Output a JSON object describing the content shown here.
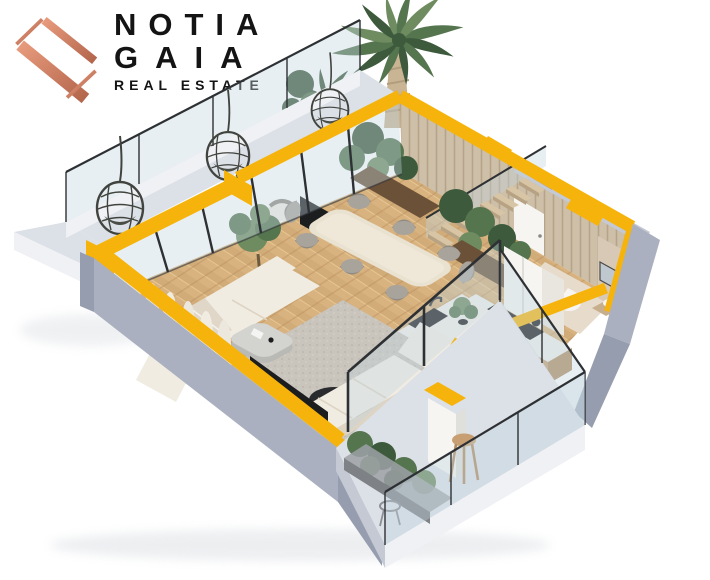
{
  "brand": {
    "line1": "NOTIA",
    "line2": "GAIA",
    "tagline": "REAL ESTATE",
    "mark": "ng-monogram"
  },
  "palette": {
    "yellow": "#F6B30B",
    "yellowDeep": "#DE9C00",
    "grayWall": "#AAB0BF",
    "grayWallLight": "#C4C9D4",
    "grayWallDark": "#969DAE",
    "slabTop": "#DCE0E7",
    "slabSide": "#F0F1F5",
    "glassTint": "rgba(195,212,224,0.38)",
    "frameDark": "#2E3134",
    "floorWood": "#D9B37F",
    "floorWoodDark": "#C2996A",
    "slatWood": "#CDBFA8",
    "slatLine": "#B5A489",
    "beigeWall": "#D8C9B6",
    "beigeLight": "#E7DCCB",
    "cream": "#F1ECE2",
    "creamShadow": "#DDD4C4",
    "rugGray": "#C9C4BC",
    "chairGray": "#A8A49C",
    "chairGrayDark": "#8F8B83",
    "tableCream": "#EAE2D1",
    "islandTop": "#F0EDE7",
    "islandSideA": "#C9C3B9",
    "islandSideB": "#BAB4A9",
    "counterWood": "#C5A476",
    "blackSoft": "#1C1D1F",
    "whiteSoft": "#F6F5F2",
    "green1": "#55754F",
    "green2": "#3D5A3C",
    "green3": "#6E8C60",
    "planterWood": "#6B5138",
    "trunkTan": "#C9B493",
    "logoCoral1": "#E89A7C",
    "logoCoral2": "#B3664C",
    "textDark": "#141414",
    "shadowTint": "#CBD0D7"
  },
  "scene": {
    "type": "isometric-apartment-cutaway-render",
    "elements": [
      "palm-tree",
      "balcony-hanging-chairs",
      "glass-railing",
      "living-sofas",
      "area-rug",
      "coffee-tables",
      "tv-screen",
      "dining-table-8-seats",
      "kitchen-island",
      "bar-stools",
      "kitchen-counter",
      "cooktop",
      "fridge",
      "staircase",
      "indoor-planters",
      "olive-tree",
      "bathroom-toilet",
      "bathroom-vanity",
      "terrace",
      "terrace-planter",
      "terrace-stool",
      "curtains"
    ]
  }
}
